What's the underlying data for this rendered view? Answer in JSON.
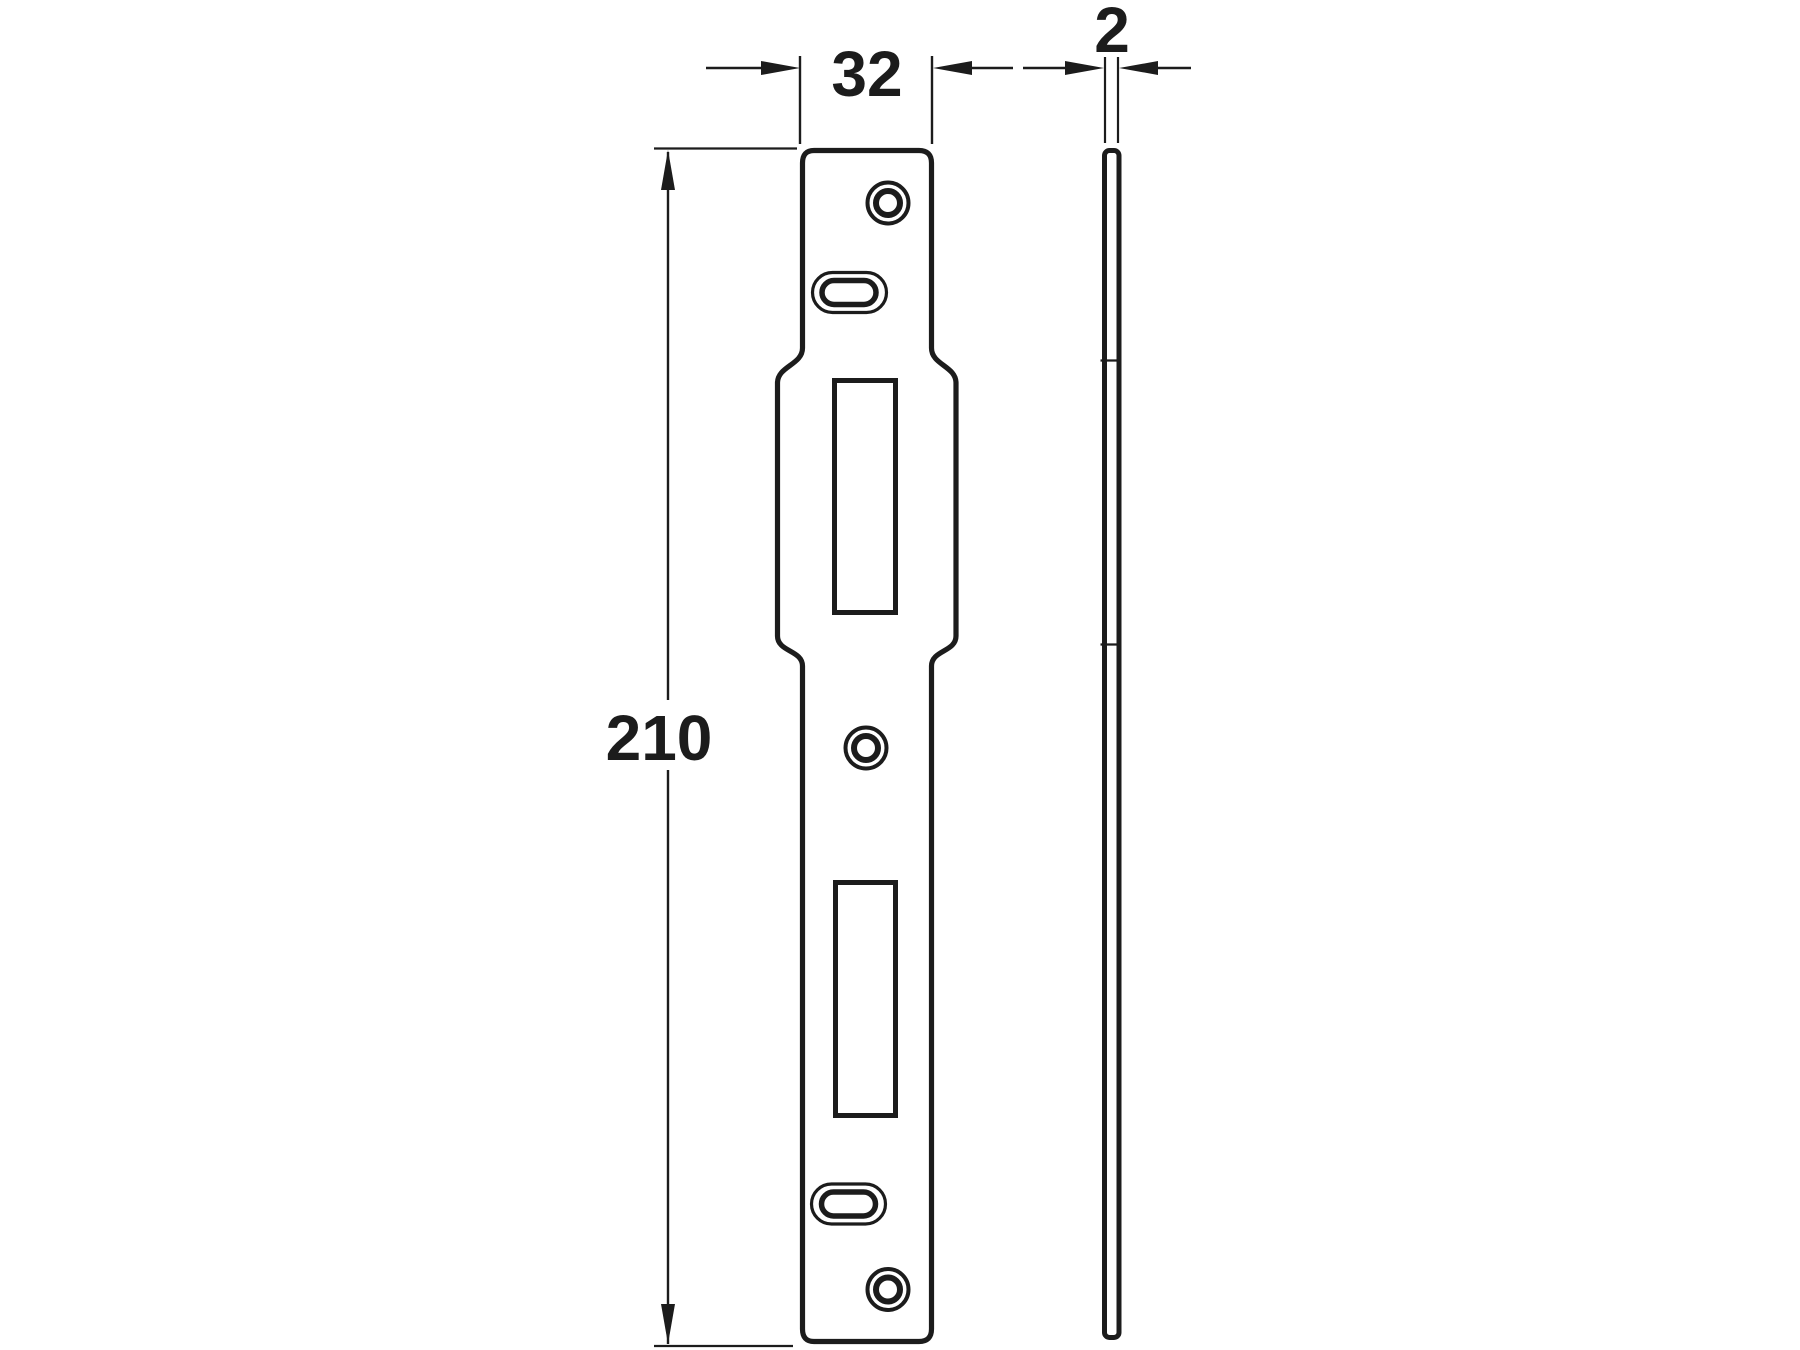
{
  "drawing": {
    "dimensions": {
      "width": {
        "label": "32"
      },
      "thickness": {
        "label": "2"
      },
      "height": {
        "label": "210"
      }
    },
    "colors": {
      "line": "#1c1c1c",
      "background": "#ffffff"
    }
  }
}
